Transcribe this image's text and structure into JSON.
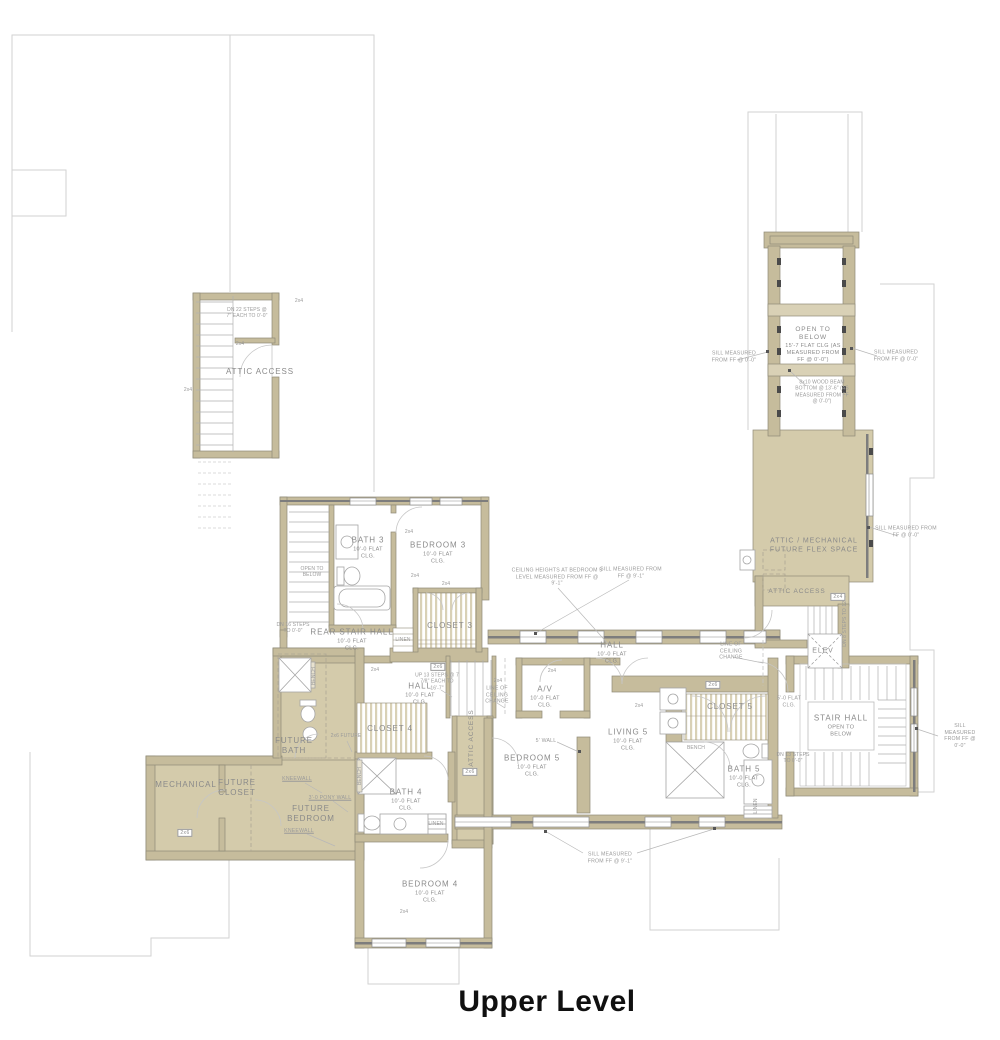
{
  "title": "Upper Level",
  "colors": {
    "wall_fill": "#c6bc9c",
    "room_fill": "#d4cbab",
    "line_gray": "#9c9c9c",
    "faint_outline": "#d2d2d2",
    "text_gray": "#8d8d8d"
  },
  "rooms": {
    "attic_access_tl": "ATTIC ACCESS",
    "bath3": {
      "name": "BATH 3",
      "sub": "10'-0 FLAT CLG."
    },
    "bedroom3": {
      "name": "BEDROOM 3",
      "sub": "10'-0 FLAT CLG."
    },
    "open_below_left": "OPEN TO BELOW",
    "rear_stair_hall": {
      "name": "REAR STAIR HALL",
      "sub": "10'-0 FLAT CLG."
    },
    "closet3": "CLOSET 3",
    "linen": "LINEN",
    "hall_upper": {
      "name": "HALL",
      "sub": "10'-0 FLAT CLG."
    },
    "hall_lower": {
      "name": "HALL",
      "sub": "10'-0 FLAT CLG."
    },
    "av": {
      "name": "A/V",
      "sub": "10'-0 FLAT CLG."
    },
    "closet4": "CLOSET 4",
    "bath4": {
      "name": "BATH 4",
      "sub": "10'-0 FLAT CLG."
    },
    "future_bath": "FUTURE BATH",
    "mechanical": "MECHANICAL",
    "future_closet": "FUTURE CLOSET",
    "future_bedroom": "FUTURE BEDROOM",
    "bedroom4": {
      "name": "BEDROOM 4",
      "sub": "10'-0 FLAT CLG."
    },
    "bedroom5": {
      "name": "BEDROOM 5",
      "sub": "10'-0 FLAT CLG."
    },
    "living5": {
      "name": "LIVING 5",
      "sub": "10'-0 FLAT CLG."
    },
    "closet5": "CLOSET 5",
    "bath5": {
      "name": "BATH 5",
      "sub": "10'-0 FLAT CLG."
    },
    "stair_hall": {
      "name": "STAIR HALL",
      "sub": "OPEN TO BELOW"
    },
    "stair_hall_clg": "5'-0 FLAT CLG.",
    "elev": "ELEV",
    "attic_access_right": "ATTIC ACCESS",
    "attic_access_strip": "ATTIC ACCESS",
    "flex_line1": "ATTIC / MECHANICAL",
    "flex_line2": "FUTURE FLEX SPACE",
    "open_below_void": {
      "name": "OPEN TO BELOW",
      "sub": "15'-7 FLAT CLG (AS MEASURED FROM FF @ 0'-0\")"
    },
    "bench": "BENCH"
  },
  "annotations": {
    "sill_0": "SILL MEASURED FROM FF @ 0'-0\"",
    "sill_9": "SILL MEASURED FROM FF @ 9'-1\"",
    "ceiling_note": "CEILING HEIGHTS AT BEDROOM 5 LEVEL MEASURED FROM FF @ 9'-1\"",
    "beam_note": "8x10 WOOD BEAM BOTTOM @ 13'-6\" (AS MEASURED FROM FF @ 0'-0\")",
    "line_of_ceiling_change": "LINE OF CEILING CHANGE",
    "up_steps": "UP 13 STEPS @ 7 7/8\" EACH TO 16'-7\"",
    "dn_steps_attic": "DN 22 STEPS @ 7\" EACH TO 0'-0\"",
    "dn_steps_rear": "DN 16 STEPS TO 0'-0\"",
    "dn_steps_stair_hall": "DN 13 STEPS TO 0'-0\"",
    "dn_steps_elev": "DN 8 STEPS TO 12'-7\"",
    "pony_wall": "3'-0 PONY WALL",
    "kneewall": "KNEEWALL",
    "five_wall": "5' WALL",
    "stud24": "2x4",
    "stud26": "2x6",
    "future26": "2x6 FUTURE"
  }
}
